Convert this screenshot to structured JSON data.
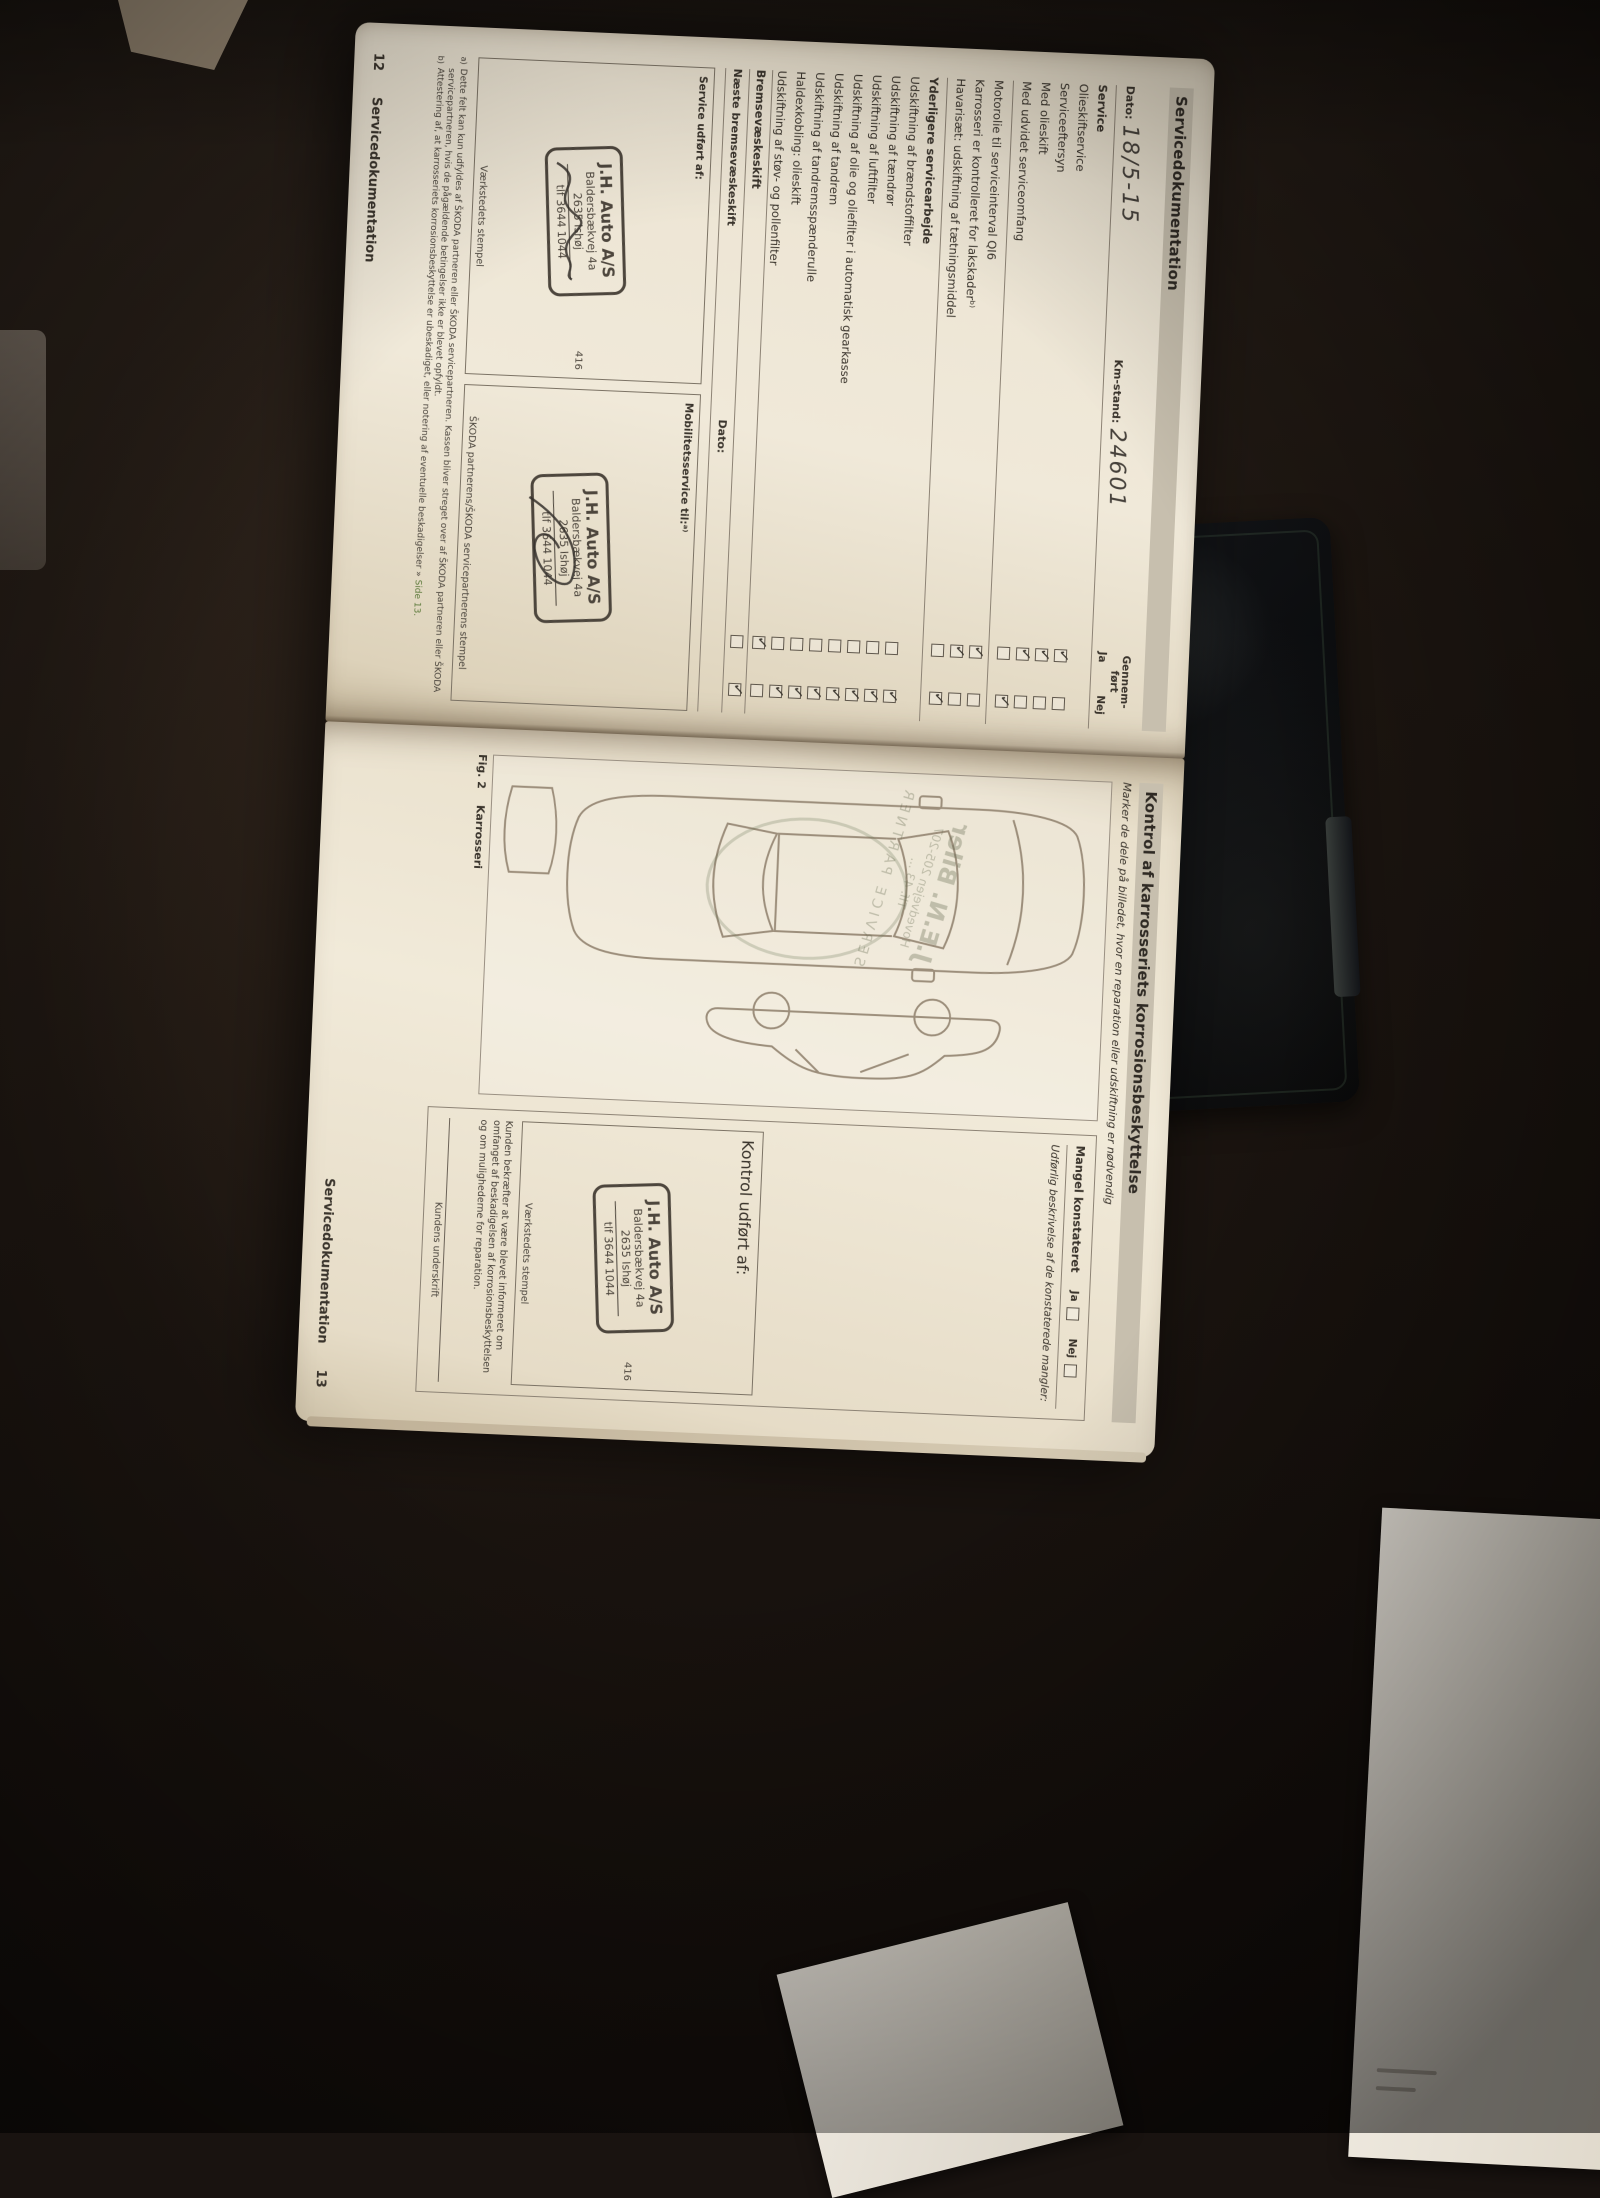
{
  "scene": {
    "background_color": "#1a1410",
    "paper_color": "#f0e9d9",
    "band_color": "#c7bfae",
    "ink_color": "#3a342c",
    "stamp_ink": "#4d463d",
    "link_color": "#5d7a3b"
  },
  "page12": {
    "header": "Servicedokumentation",
    "date_label": "Dato:",
    "date_value": "18/5-15",
    "km_label": "Km-stand:",
    "km_value": "24601",
    "done_label_1": "Gennem-",
    "done_label_2": "ført",
    "yes_label": "Ja",
    "no_label": "Nej",
    "service_section_label": "Service",
    "service_items": [
      {
        "label": "Olieskiftservice",
        "state": "ja"
      },
      {
        "label": "Serviceeftersyn",
        "state": "ja"
      },
      {
        "label": "Med olieskift",
        "state": "ja"
      },
      {
        "label": "Med udvidet serviceomfang",
        "state": "nej"
      }
    ],
    "mid_items": [
      {
        "label": "Motorolie til serviceinterval QI6",
        "state": "ja"
      },
      {
        "label": "Karrosseri er kontrolleret for lakskaderᵇ⁾",
        "state": "ja"
      },
      {
        "label": "Havarisæt: udskiftning af tætningsmiddel",
        "state": "nej"
      }
    ],
    "further_header": "Yderligere servicearbejde",
    "further_items": [
      {
        "label": "Udskiftning af brændstoffilter",
        "state": "nej"
      },
      {
        "label": "Udskiftning af tændrør",
        "state": "nej"
      },
      {
        "label": "Udskiftning af luftfilter",
        "state": "nej"
      },
      {
        "label": "Udskiftning af olie og oliefilter i automatisk gearkasse",
        "state": "nej"
      },
      {
        "label": "Udskiftning af tandrem",
        "state": "nej"
      },
      {
        "label": "Udskiftning af tandremsspænderulle",
        "state": "nej"
      },
      {
        "label": "Haldexkobling: olieskift",
        "state": "nej"
      },
      {
        "label": "Udskiftning af støv- og pollenfilter",
        "state": "ja"
      }
    ],
    "brake_item": {
      "label": "Bremsevæskeskift",
      "state": "nej"
    },
    "next_brake_label": "Næste bremsevæskeskift",
    "next_brake_date_label": "Dato:",
    "service_by_label": "Service udført af:",
    "mobility_label": "Mobilitetsservice til:ᵃ⁾",
    "workshop_stamp_caption": "Værkstedets stempel",
    "partner_stamp_caption": "ŠKODA partnerens/ŠKODA servicepartnerens stempel",
    "footnote_a_mark": "a)",
    "footnote_a": "Dette felt kan kun udfyldes af ŠKODA partneren eller ŠKODA servicepartneren. Kassen bliver streget over af ŠKODA partneren eller ŠKODA servicepartneren, hvis de pågældende betingelser ikke er blevet opfyldt.",
    "footnote_b_mark": "b)",
    "footnote_b": "Attestering af, at karrosseriets korrosionsbeskyttelse er ubeskadiget, eller notering af eventuelle beskadigelser » ",
    "footnote_b_link": "Side 13.",
    "footer_number": "12",
    "footer_label": "Servicedokumentation"
  },
  "stamp": {
    "name": "J.H. Auto A/S",
    "street": "Baldersbækvej 4a",
    "city": "2635 Ishøj",
    "phone": "tlf 3644 1044",
    "dealer_number": "416"
  },
  "page13": {
    "header": "Kontrol af karrosseriets korrosionsbeskyttelse",
    "intro": "Marker de dele på billedet, hvor en reparation eller udskiftning er nødvendig",
    "defect_label": "Mangel konstateret",
    "yes_label": "Ja",
    "no_label": "Nej",
    "description_label": "Udførlig beskrivelse af de konstaterede mangler:",
    "control_label": "Kontrol udført af:",
    "workshop_stamp_caption": "Værkstedets stempel",
    "confirm_text": "Kunden bekræfter at være blevet informeret om omfanget af beskadigelsen af korrosionsbeskyttelsen og om mulighederne for reparation.",
    "signature_label": "Kundens underskrift",
    "fig_caption_1": "Fig. 2",
    "fig_caption_2": "Karrosseri",
    "watermark_line_1": "J.E.N. Biler",
    "watermark_line_2": "Hovedvejen 205-207",
    "watermark_line_3": "Tlf. 43 ...",
    "watermark_arc": "SERVICE PARTNER",
    "footer_label": "Servicedokumentation",
    "footer_number": "13"
  }
}
